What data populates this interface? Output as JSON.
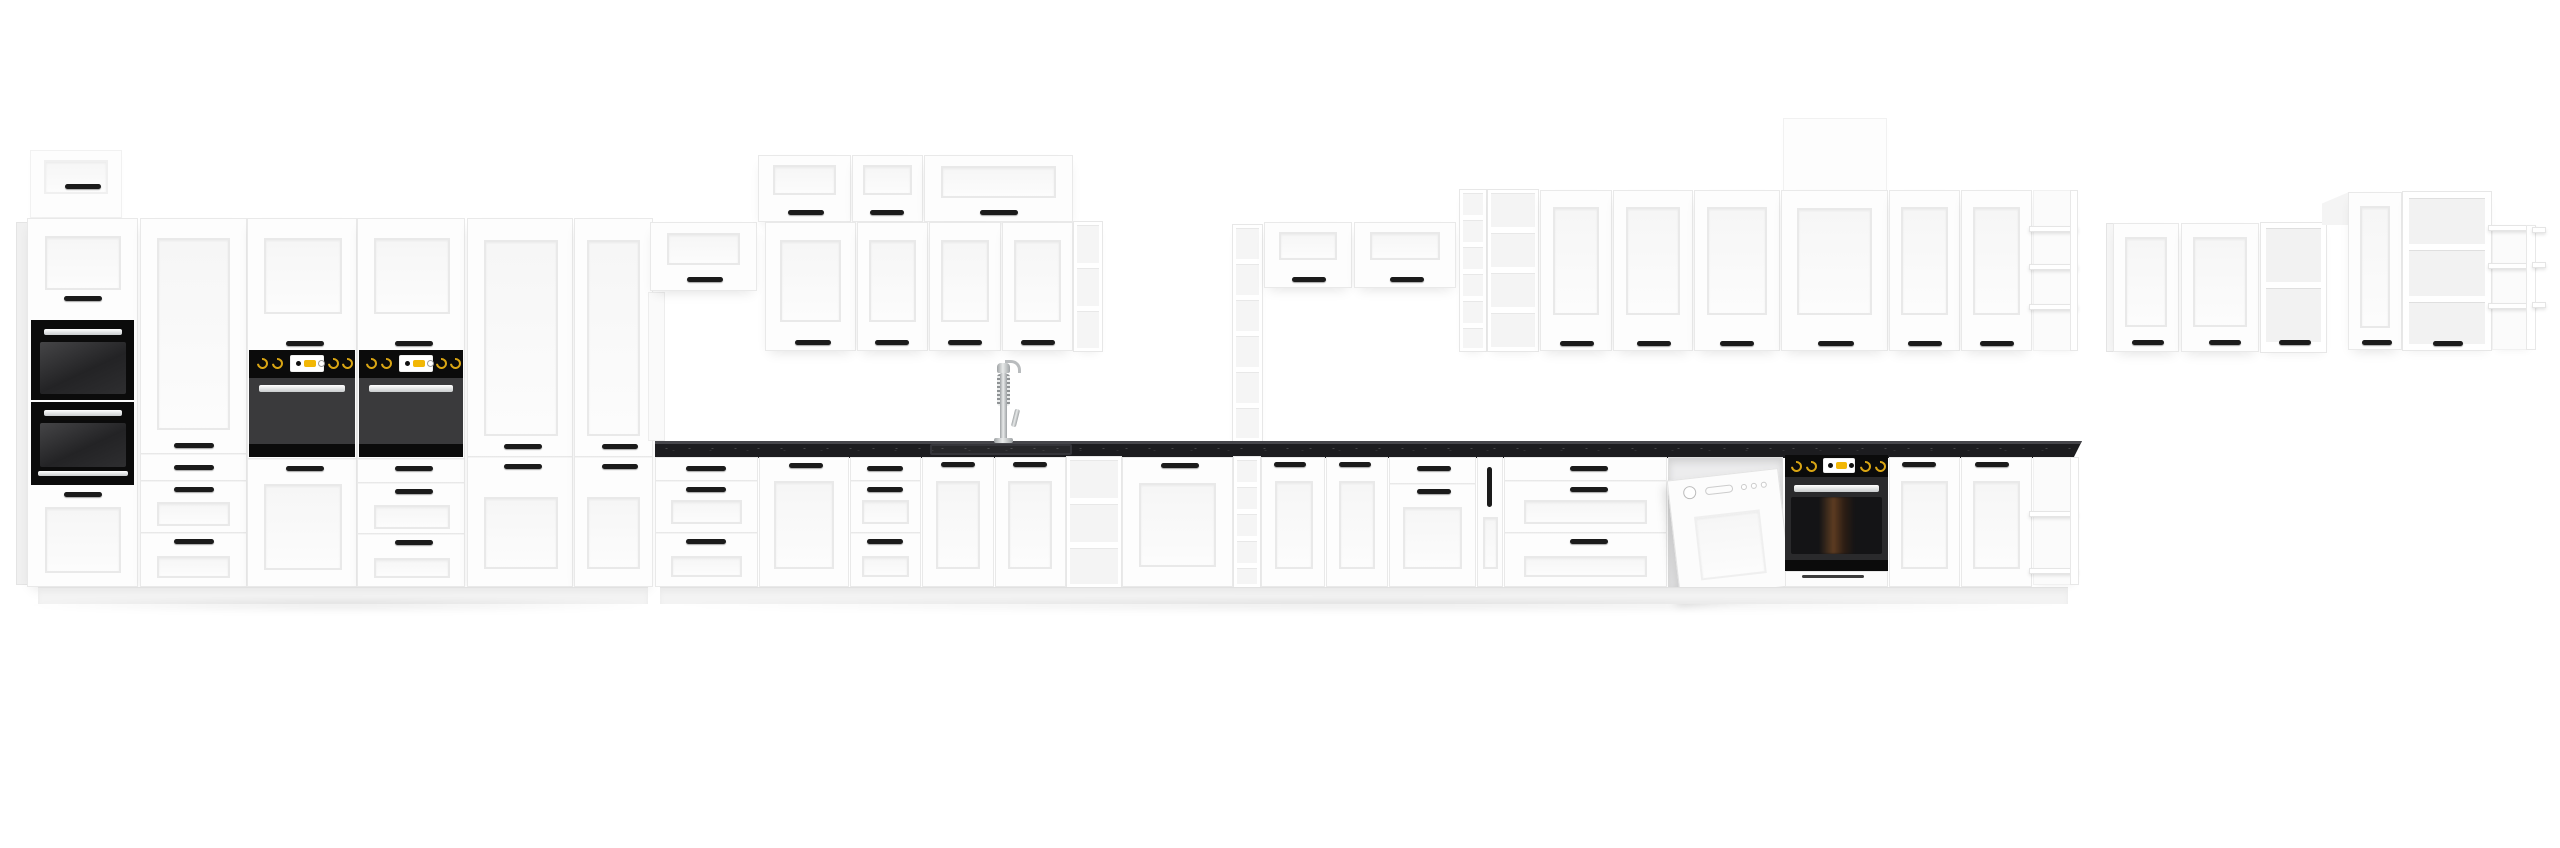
{
  "meta": {
    "description": "Product photo of a white shaker-style modular kitchen furniture set with black stone worktop and black built-in appliances, shown on a plain white background",
    "visible_text": "none"
  },
  "palette": {
    "bg": "#ffffff",
    "cab": "#fdfdfd",
    "cab-border": "#e9e9e9",
    "handle": "#1b1b1b",
    "counter": "#1c1c1f",
    "counter-edge": "#46464b",
    "black": "#0b0b0b",
    "oven-door": "#3a3a3c",
    "gold": "#d9a514",
    "display-yellow": "#f2b705",
    "plinth": "#f3f3f3"
  },
  "inventory": {
    "left_tall_run": [
      "small wall cabinet",
      "tall housing with built-in microwave and built-in oven",
      "tall cabinet with door and three drawers",
      "two tall oven housings each with built-in oven, control knobs and yellow display",
      "two tall larder cabinets with double doors"
    ],
    "middle_run": [
      "bridge wall cabinet over open niche",
      "top row of three lift-up wall cabinets",
      "row of four wall cabinet doors with open shelf end",
      "tall open cube shelf column",
      "two lift-up wall cabinets",
      "black speckled worktop",
      "spring pull-out kitchen faucet over undermount sink",
      "base drawer units and door units",
      "open base shelf unit",
      "narrow pull-out cargo with vertical handle",
      "dishwasher with door ajar",
      "built-in under-counter oven with control knobs and yellow display",
      "open corner shelf end unit"
    ],
    "right_wall_group": [
      "open cube column",
      "open shelf unit",
      "six wall cabinet doors",
      "taller top box above wide door",
      "open corner shelf end unit"
    ],
    "far_right_wall_group": [
      "two wall cabinet doors",
      "open-front display cabinet with shelf",
      "taller narrow door cabinet",
      "taller open-front display cabinet with shelves",
      "stepped open corner shelves"
    ],
    "appliance_finishes": [
      "black glass",
      "stainless steel",
      "white"
    ]
  }
}
